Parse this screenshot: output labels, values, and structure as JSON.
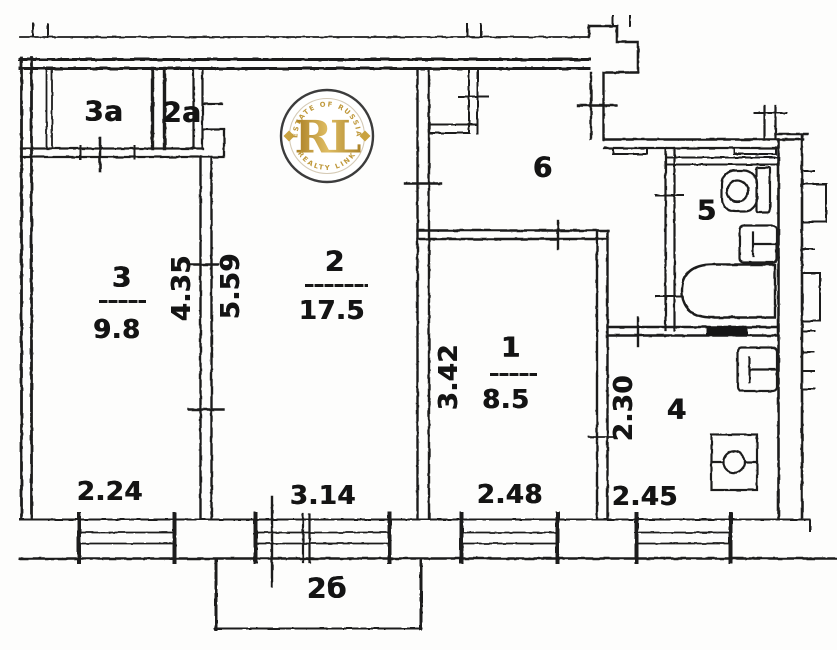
{
  "watermark": {
    "initials": "RL",
    "arc_top": "ESTATE OF RUSSIA",
    "arc_bottom": "REALTY LINK",
    "gold": "#c39b3d",
    "ring": "#3c3c3c"
  },
  "rooms": [
    {
      "id": "3a",
      "label": "3а"
    },
    {
      "id": "2a",
      "label": "2а"
    },
    {
      "id": "3",
      "label": "3",
      "area": "9.8"
    },
    {
      "id": "2",
      "label": "2",
      "area": "17.5"
    },
    {
      "id": "1",
      "label": "1",
      "area": "8.5"
    },
    {
      "id": "4",
      "label": "4"
    },
    {
      "id": "5",
      "label": "5"
    },
    {
      "id": "6",
      "label": "6"
    },
    {
      "id": "balcony",
      "label": "2б"
    }
  ],
  "dimensions": [
    {
      "id": "room3-width",
      "value": "2.24"
    },
    {
      "id": "room3-height",
      "value": "4.35"
    },
    {
      "id": "room2-height",
      "value": "5.59"
    },
    {
      "id": "room2-width",
      "value": "3.14"
    },
    {
      "id": "room1-height",
      "value": "3.42"
    },
    {
      "id": "room1-width",
      "value": "2.48"
    },
    {
      "id": "room4-height",
      "value": "2.30"
    },
    {
      "id": "room4-width",
      "value": "2.45"
    }
  ],
  "ink": "#1c1c1c"
}
